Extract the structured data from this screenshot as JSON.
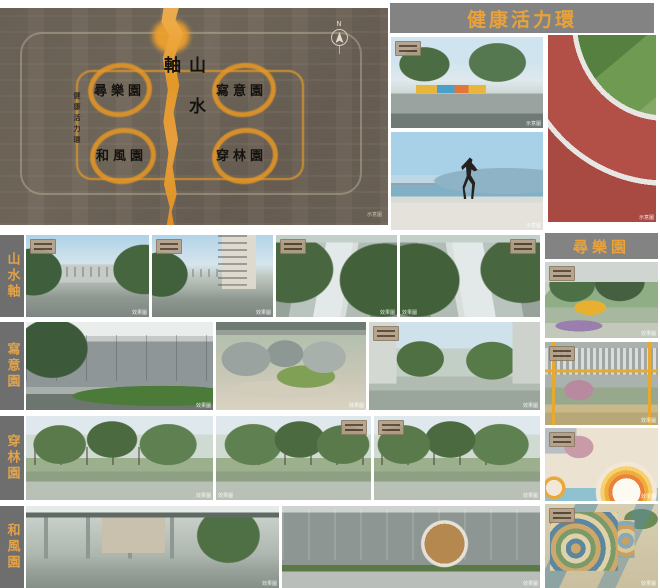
{
  "colors": {
    "accent_orange": "#E8A23C",
    "banner_gray": "#838383",
    "label_gray": "#6E6E6E",
    "plan_brown": "#6F655A"
  },
  "site_plan": {
    "axis_title": "山水軸",
    "ring_label": "健康活力環",
    "north_label": "N",
    "caption": "示意圖",
    "zones": [
      {
        "name": "尋樂園"
      },
      {
        "name": "寫意園"
      },
      {
        "name": "和風園"
      },
      {
        "name": "穿林園"
      }
    ]
  },
  "health_ring": {
    "title": "健康活力環",
    "photos": [
      {
        "scene": "park-playground",
        "caption": "示意圖"
      },
      {
        "scene": "waterfront-jogger",
        "caption": "示意圖"
      },
      {
        "scene": "red-running-track",
        "caption": "示意圖"
      }
    ]
  },
  "rows": [
    {
      "label": "山水軸",
      "photos": [
        {
          "scene": "street-view-1",
          "caption": "效果圖"
        },
        {
          "scene": "street-view-2",
          "caption": "效果圖"
        },
        {
          "scene": "water-axis-aerial-1",
          "caption": "效果圖"
        },
        {
          "scene": "water-axis-aerial-2",
          "caption": "效果圖"
        }
      ]
    },
    {
      "label": "寫意園",
      "photos": [
        {
          "scene": "feature-wall-garden",
          "caption": "效果圖"
        },
        {
          "scene": "zen-rock-garden",
          "caption": "效果圖"
        },
        {
          "scene": "tree-lined-avenue",
          "caption": "效果圖"
        }
      ]
    },
    {
      "label": "穿林園",
      "photos": [
        {
          "scene": "forest-grove-plaza-1",
          "caption": "效果圖"
        },
        {
          "scene": "forest-grove-plaza-2",
          "caption": "效果圖"
        },
        {
          "scene": "forest-grove-plaza-3",
          "caption": "效果圖"
        }
      ]
    },
    {
      "label": "和風園",
      "photos": [
        {
          "scene": "garden-pavilion",
          "caption": "效果圖"
        },
        {
          "scene": "moon-gate-wall",
          "caption": "效果圖"
        }
      ]
    }
  ],
  "right_column": {
    "title": "尋樂園",
    "photos": [
      {
        "scene": "tree-playground",
        "caption": "效果圖"
      },
      {
        "scene": "yellow-frame-playground",
        "caption": "效果圖"
      },
      {
        "scene": "rainbow-arch-playground",
        "caption": "效果圖"
      },
      {
        "scene": "aerial-colorful-playground",
        "caption": "效果圖"
      }
    ]
  }
}
